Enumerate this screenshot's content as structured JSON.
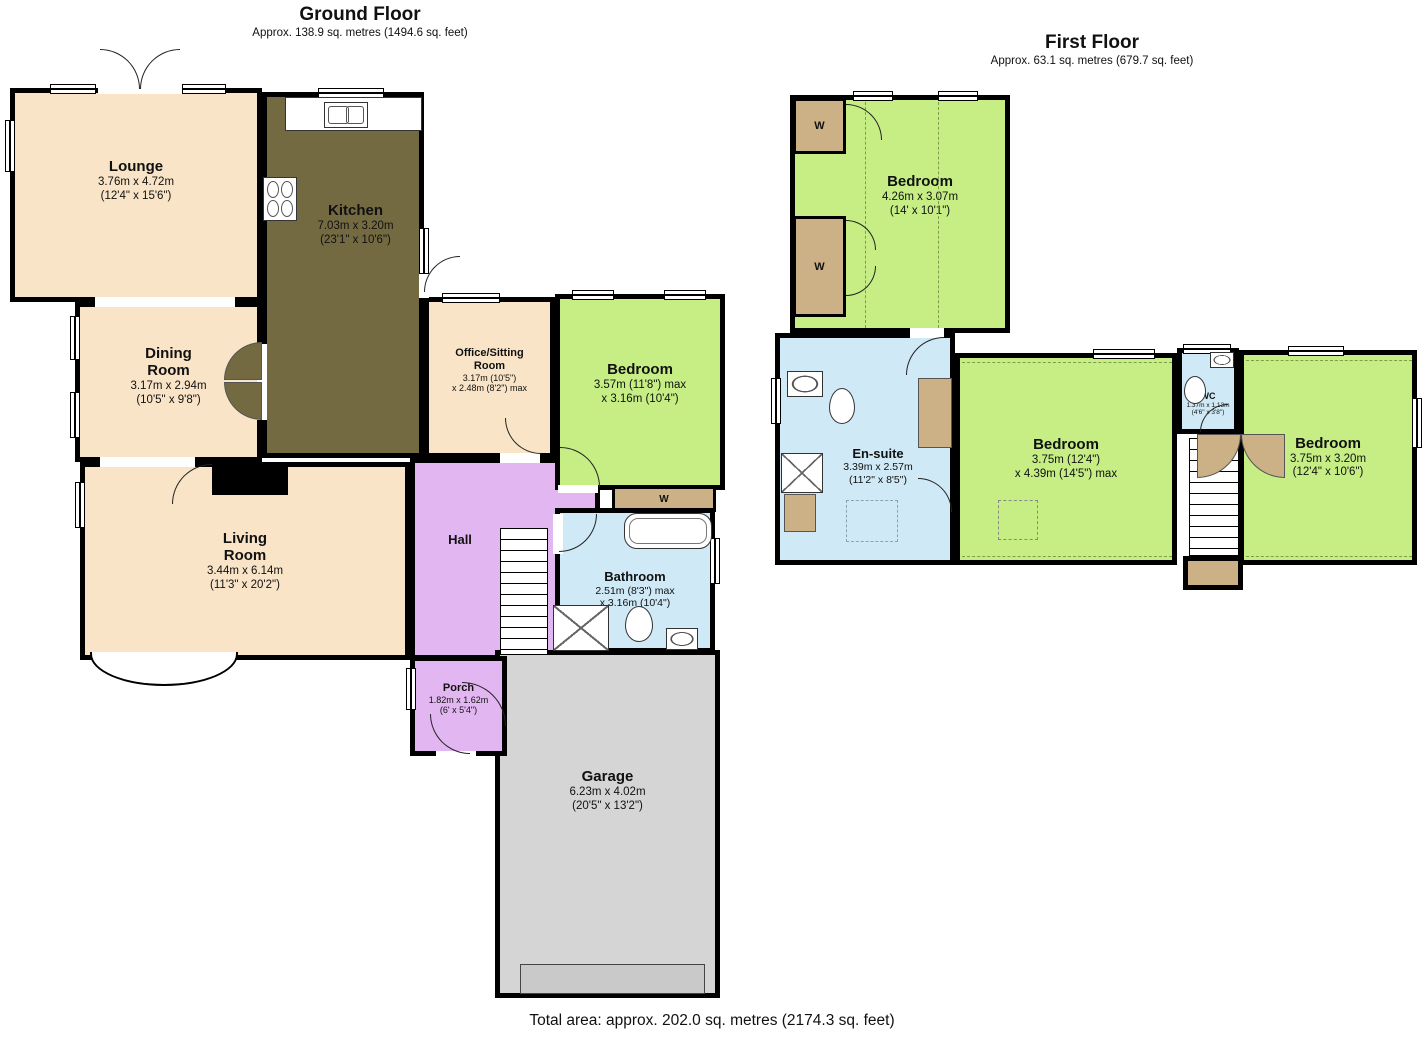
{
  "colors": {
    "background": "#ffffff",
    "wall": "#000000",
    "cream": "#f9e4c7",
    "kitchen": "#746a42",
    "green": "#c6ee85",
    "purple": "#e2b6f1",
    "blue": "#cfe9f6",
    "gray": "#d5d5d5",
    "tan": "#cdb186"
  },
  "ground_floor": {
    "title": "Ground Floor",
    "subtitle": "Approx. 138.9 sq. metres (1494.6 sq. feet)",
    "rooms": {
      "lounge": {
        "name": "Lounge",
        "size1": "3.76m x 4.72m",
        "size2": "(12'4\" x 15'6\")"
      },
      "kitchen": {
        "name": "Kitchen",
        "size1": "7.03m x 3.20m",
        "size2": "(23'1\" x 10'6\")"
      },
      "dining": {
        "name1": "Dining",
        "name2": "Room",
        "size1": "3.17m x 2.94m",
        "size2": "(10'5\" x 9'8\")"
      },
      "office": {
        "name1": "Office/Sitting",
        "name2": "Room",
        "size1": "3.17m (10'5\")",
        "size2": "x 2.48m (8'2\") max"
      },
      "bedroom": {
        "name": "Bedroom",
        "size1": "3.57m (11'8\") max",
        "size2": "x 3.16m (10'4\")"
      },
      "living": {
        "name1": "Living",
        "name2": "Room",
        "size1": "3.44m x 6.14m",
        "size2": "(11'3\" x 20'2\")"
      },
      "hall": {
        "name": "Hall"
      },
      "bathroom": {
        "name": "Bathroom",
        "size1": "2.51m (8'3\") max",
        "size2": "x 3.16m (10'4\")"
      },
      "porch": {
        "name": "Porch",
        "size1": "1.82m x 1.62m",
        "size2": "(6' x 5'4\")"
      },
      "garage": {
        "name": "Garage",
        "size1": "6.23m x 4.02m",
        "size2": "(20'5\" x 13'2\")"
      },
      "wardrobe": {
        "label": "W"
      }
    }
  },
  "first_floor": {
    "title": "First Floor",
    "subtitle": "Approx. 63.1 sq. metres (679.7 sq. feet)",
    "rooms": {
      "bedroom_top": {
        "name": "Bedroom",
        "size1": "4.26m x 3.07m",
        "size2": "(14' x 10'1\")"
      },
      "ensuite": {
        "name": "En-suite",
        "size1": "3.39m x 2.57m",
        "size2": "(11'2\" x 8'5\")"
      },
      "bedroom_mid": {
        "name": "Bedroom",
        "size1": "3.75m (12'4\")",
        "size2": "x 4.39m (14'5\") max"
      },
      "wc": {
        "name": "WC",
        "size1": "1.37m x 1.13m",
        "size2": "(4'6\" x 3'8\")"
      },
      "bedroom_right": {
        "name": "Bedroom",
        "size1": "3.75m x 3.20m",
        "size2": "(12'4\" x 10'6\")"
      },
      "wardrobe_a": {
        "label": "W"
      },
      "wardrobe_b": {
        "label": "W"
      }
    }
  },
  "footer": {
    "total_area": "Total area: approx. 202.0 sq. metres (2174.3 sq. feet)"
  }
}
